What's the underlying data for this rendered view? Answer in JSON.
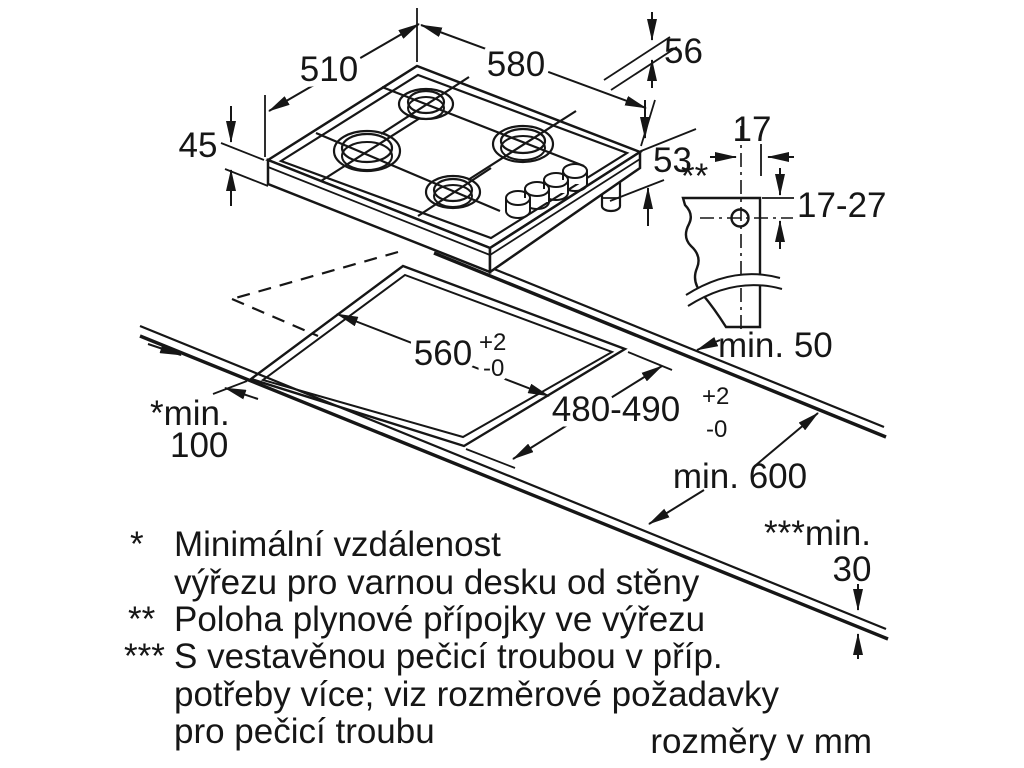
{
  "diagram_title": "gas-hob-installation-dimensions",
  "dimensions": {
    "hob_depth_top": "510",
    "hob_width": "580",
    "hob_height_with_grate": "56",
    "hob_body_height": "45",
    "connector_height": "53",
    "gas_offset_in_cutout": "17",
    "gas_position_marker": "**",
    "gas_depth_range": "17-27",
    "wall_clearance": "min. 50",
    "cutout_width": "560",
    "cutout_width_tol_plus": "+2",
    "cutout_width_tol_minus": "-0",
    "cutout_depth": "480-490",
    "cutout_depth_tol_plus": "+2",
    "cutout_depth_tol_minus": "-0",
    "side_clearance_label": "*min.",
    "side_clearance_value": "100",
    "worktop_depth": "min. 600",
    "oven_clearance_label": "***min.",
    "oven_clearance_value": "30"
  },
  "footnotes": {
    "items": [
      {
        "marker": "*",
        "line1": "Minimální vzdálenost",
        "line2": "výřezu pro varnou desku od stěny"
      },
      {
        "marker": "**",
        "line1": "Poloha plynové přípojky ve výřezu"
      },
      {
        "marker": "***",
        "line1": "S vestavěnou pečicí troubou v příp.",
        "line2": "potřeby více; viz rozměrové požadavky",
        "line3": "pro pečicí troubu"
      }
    ],
    "units_note": "rozměry v mm"
  }
}
